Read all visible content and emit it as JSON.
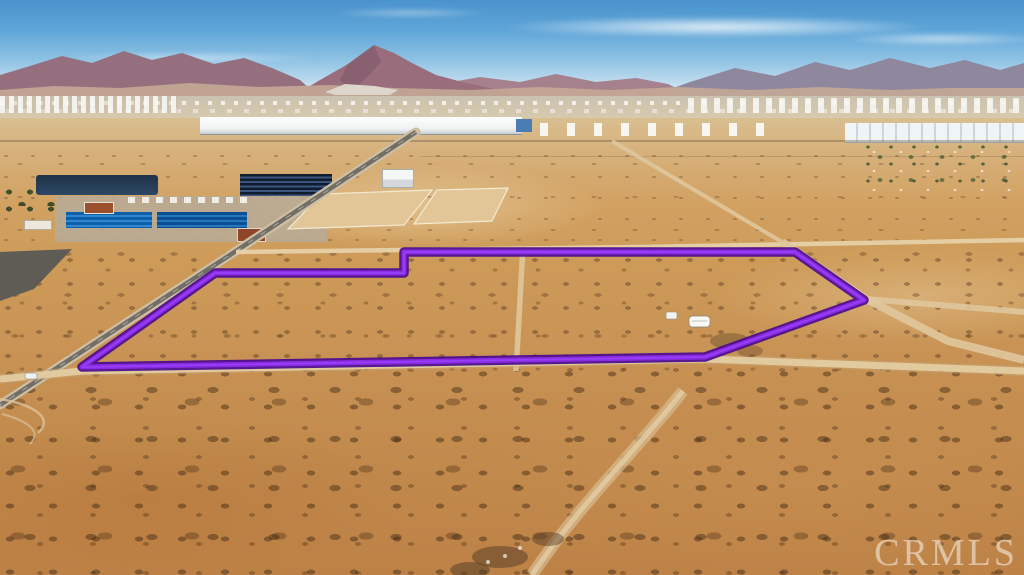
{
  "watermark": {
    "text": "CRMLS"
  },
  "overlay": {
    "parcel_outline_points": "82,367 215,273 404,273 404,252 795,252 864,300 705,357",
    "outline_color": "#8a2be2",
    "outline_casing_color": "#4b0b8f"
  },
  "palette": {
    "sky_top": "#4a93cc",
    "sky_horizon": "#e9f3f8",
    "mountains": "#956f7e",
    "desert_mid": "#d2a263",
    "desert_foreground": "#bd8146",
    "paved_road": "#726e66",
    "dirt_road": "#e4cca2",
    "pond_water": "#2c4864",
    "solar_panels": "#2f88cf"
  }
}
